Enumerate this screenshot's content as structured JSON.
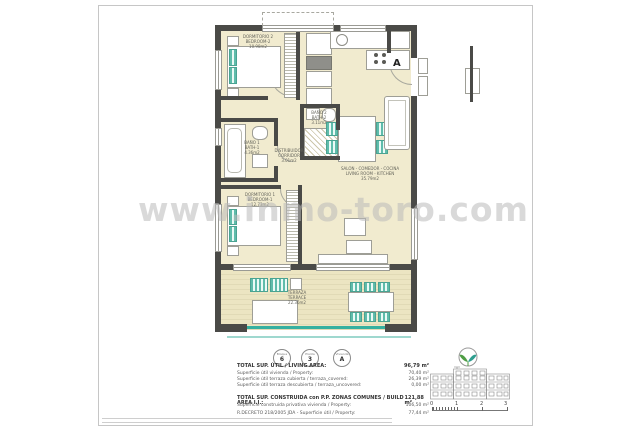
{
  "watermark": {
    "text": "www.inmo-toro.com"
  },
  "plan": {
    "entrance_label": "A",
    "colors": {
      "wall": "#4a4a47",
      "floor": "#f1ebcf",
      "accent_teal": "#5fbcab",
      "balustrade": "#35b0a0"
    },
    "rooms": [
      {
        "id": "bedroom2",
        "name_es": "DORMITORIO 2",
        "name_en": "BEDROOM-2",
        "area": "10.98m2"
      },
      {
        "id": "bath2",
        "name_es": "BAÑO 2",
        "name_en": "BATH-2",
        "area": "3.11m2"
      },
      {
        "id": "bath1",
        "name_es": "BAÑO 1",
        "name_en": "BATH-1",
        "area": "4.36m2"
      },
      {
        "id": "corridor",
        "name_es": "DISTRIBUIDOR",
        "name_en": "CORRIDOR",
        "area": "3.01m2"
      },
      {
        "id": "living",
        "name_es": "SALON - COMEDOR - COCINA",
        "name_en": "LIVING ROOM - KITCHEN",
        "area": "35.79m2"
      },
      {
        "id": "bedroom1",
        "name_es": "DORMITORIO 1",
        "name_en": "BEDROOM-1",
        "area": "12.73m2"
      },
      {
        "id": "terrace",
        "name_es": "TERRAZA",
        "name_en": "TERRACE",
        "area": "22.36m2"
      }
    ]
  },
  "unit_badges": [
    {
      "label": "Bloque",
      "value": "6"
    },
    {
      "label": "Planta",
      "value": "3"
    },
    {
      "label": "Vivienda",
      "value": "A"
    }
  ],
  "areas_table": {
    "lines": [
      {
        "label": "TOTAL SUP. ÚTIL / LIVING AREA:",
        "value": "96,79 m²"
      },
      {
        "label": "Superficie útil vivienda / Property:",
        "value": "70,40 m²"
      },
      {
        "label": "Superficie útil terraza cubierta / terraza_covered:",
        "value": "26,39 m²"
      },
      {
        "label": "Superficie útil terraza descubierta / terraza_uncovered:",
        "value": "0,00 m²"
      },
      {
        "label": "TOTAL SUP. CONSTRUIDA con P.P. ZONAS COMUNES / BUILD AREA I.I.:",
        "value": "121,88 m²"
      },
      {
        "label": "Superficie construida privativa vivienda / Property:",
        "value": "106,50 m²"
      },
      {
        "label": "R.DECRETO 218/2005 JDA  -  Superficie útil / Property:",
        "value": "77,44 m²"
      }
    ]
  },
  "scale_bar": {
    "ticks": [
      "0",
      "1",
      "2",
      "3"
    ]
  }
}
